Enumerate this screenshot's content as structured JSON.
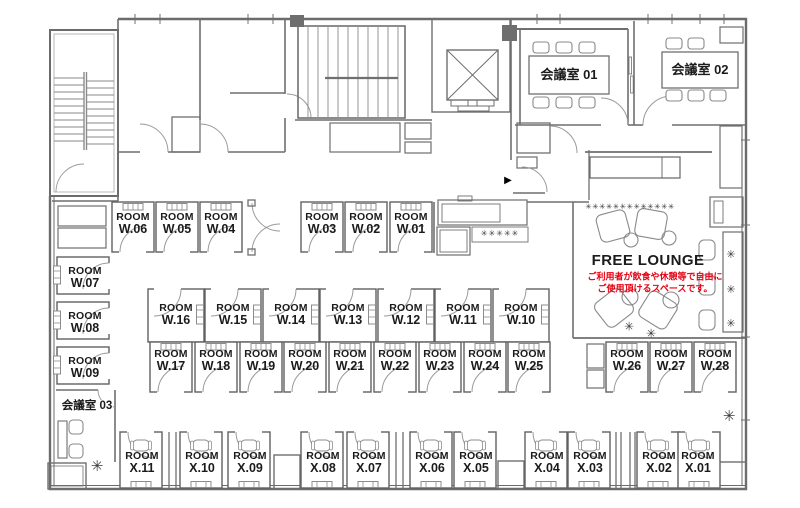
{
  "plan": {
    "type": "office-floor-plan",
    "rooms": [
      {
        "name": "ROOM",
        "number": "W.06"
      },
      {
        "name": "ROOM",
        "number": "W.05"
      },
      {
        "name": "ROOM",
        "number": "W.04"
      },
      {
        "name": "ROOM",
        "number": "W.03"
      },
      {
        "name": "ROOM",
        "number": "W.02"
      },
      {
        "name": "ROOM",
        "number": "W.01"
      },
      {
        "name": "ROOM",
        "number": "W.07"
      },
      {
        "name": "ROOM",
        "number": "W.08"
      },
      {
        "name": "ROOM",
        "number": "W.09"
      },
      {
        "name": "ROOM",
        "number": "W.16"
      },
      {
        "name": "ROOM",
        "number": "W.15"
      },
      {
        "name": "ROOM",
        "number": "W.14"
      },
      {
        "name": "ROOM",
        "number": "W.13"
      },
      {
        "name": "ROOM",
        "number": "W.12"
      },
      {
        "name": "ROOM",
        "number": "W.11"
      },
      {
        "name": "ROOM",
        "number": "W.10"
      },
      {
        "name": "ROOM",
        "number": "W.17"
      },
      {
        "name": "ROOM",
        "number": "W.18"
      },
      {
        "name": "ROOM",
        "number": "W.19"
      },
      {
        "name": "ROOM",
        "number": "W.20"
      },
      {
        "name": "ROOM",
        "number": "W.21"
      },
      {
        "name": "ROOM",
        "number": "W.22"
      },
      {
        "name": "ROOM",
        "number": "W.23"
      },
      {
        "name": "ROOM",
        "number": "W.24"
      },
      {
        "name": "ROOM",
        "number": "W.25"
      },
      {
        "name": "ROOM",
        "number": "W.26"
      },
      {
        "name": "ROOM",
        "number": "W.27"
      },
      {
        "name": "ROOM",
        "number": "W.28"
      },
      {
        "name": "ROOM",
        "number": "X.11"
      },
      {
        "name": "ROOM",
        "number": "X.10"
      },
      {
        "name": "ROOM",
        "number": "X.09"
      },
      {
        "name": "ROOM",
        "number": "X.08"
      },
      {
        "name": "ROOM",
        "number": "X.07"
      },
      {
        "name": "ROOM",
        "number": "X.06"
      },
      {
        "name": "ROOM",
        "number": "X.05"
      },
      {
        "name": "ROOM",
        "number": "X.04"
      },
      {
        "name": "ROOM",
        "number": "X.03"
      },
      {
        "name": "ROOM",
        "number": "X.02"
      },
      {
        "name": "ROOM",
        "number": "X.01"
      }
    ],
    "meeting_rooms": [
      {
        "label": "会議室 01"
      },
      {
        "label": "会議室 02"
      },
      {
        "label": "会議室 03"
      }
    ],
    "lounge": {
      "title": "FREE LOUNGE",
      "note_line1": "ご利用者が飲食や休憩等で自由に",
      "note_line2": "ご使用頂けるスペースです。"
    },
    "decor": {
      "entrance_arrow": "▶",
      "plants_row_long": "✳✳✳✳✳✳✳✳✳✳✳✳✳",
      "plants_row_short": "✳✳✳✳✳",
      "plant": "✳"
    },
    "colors": {
      "note_red": "#e60012",
      "wall_gray": "#6b6b6b",
      "text": "#1b1b1b"
    }
  }
}
